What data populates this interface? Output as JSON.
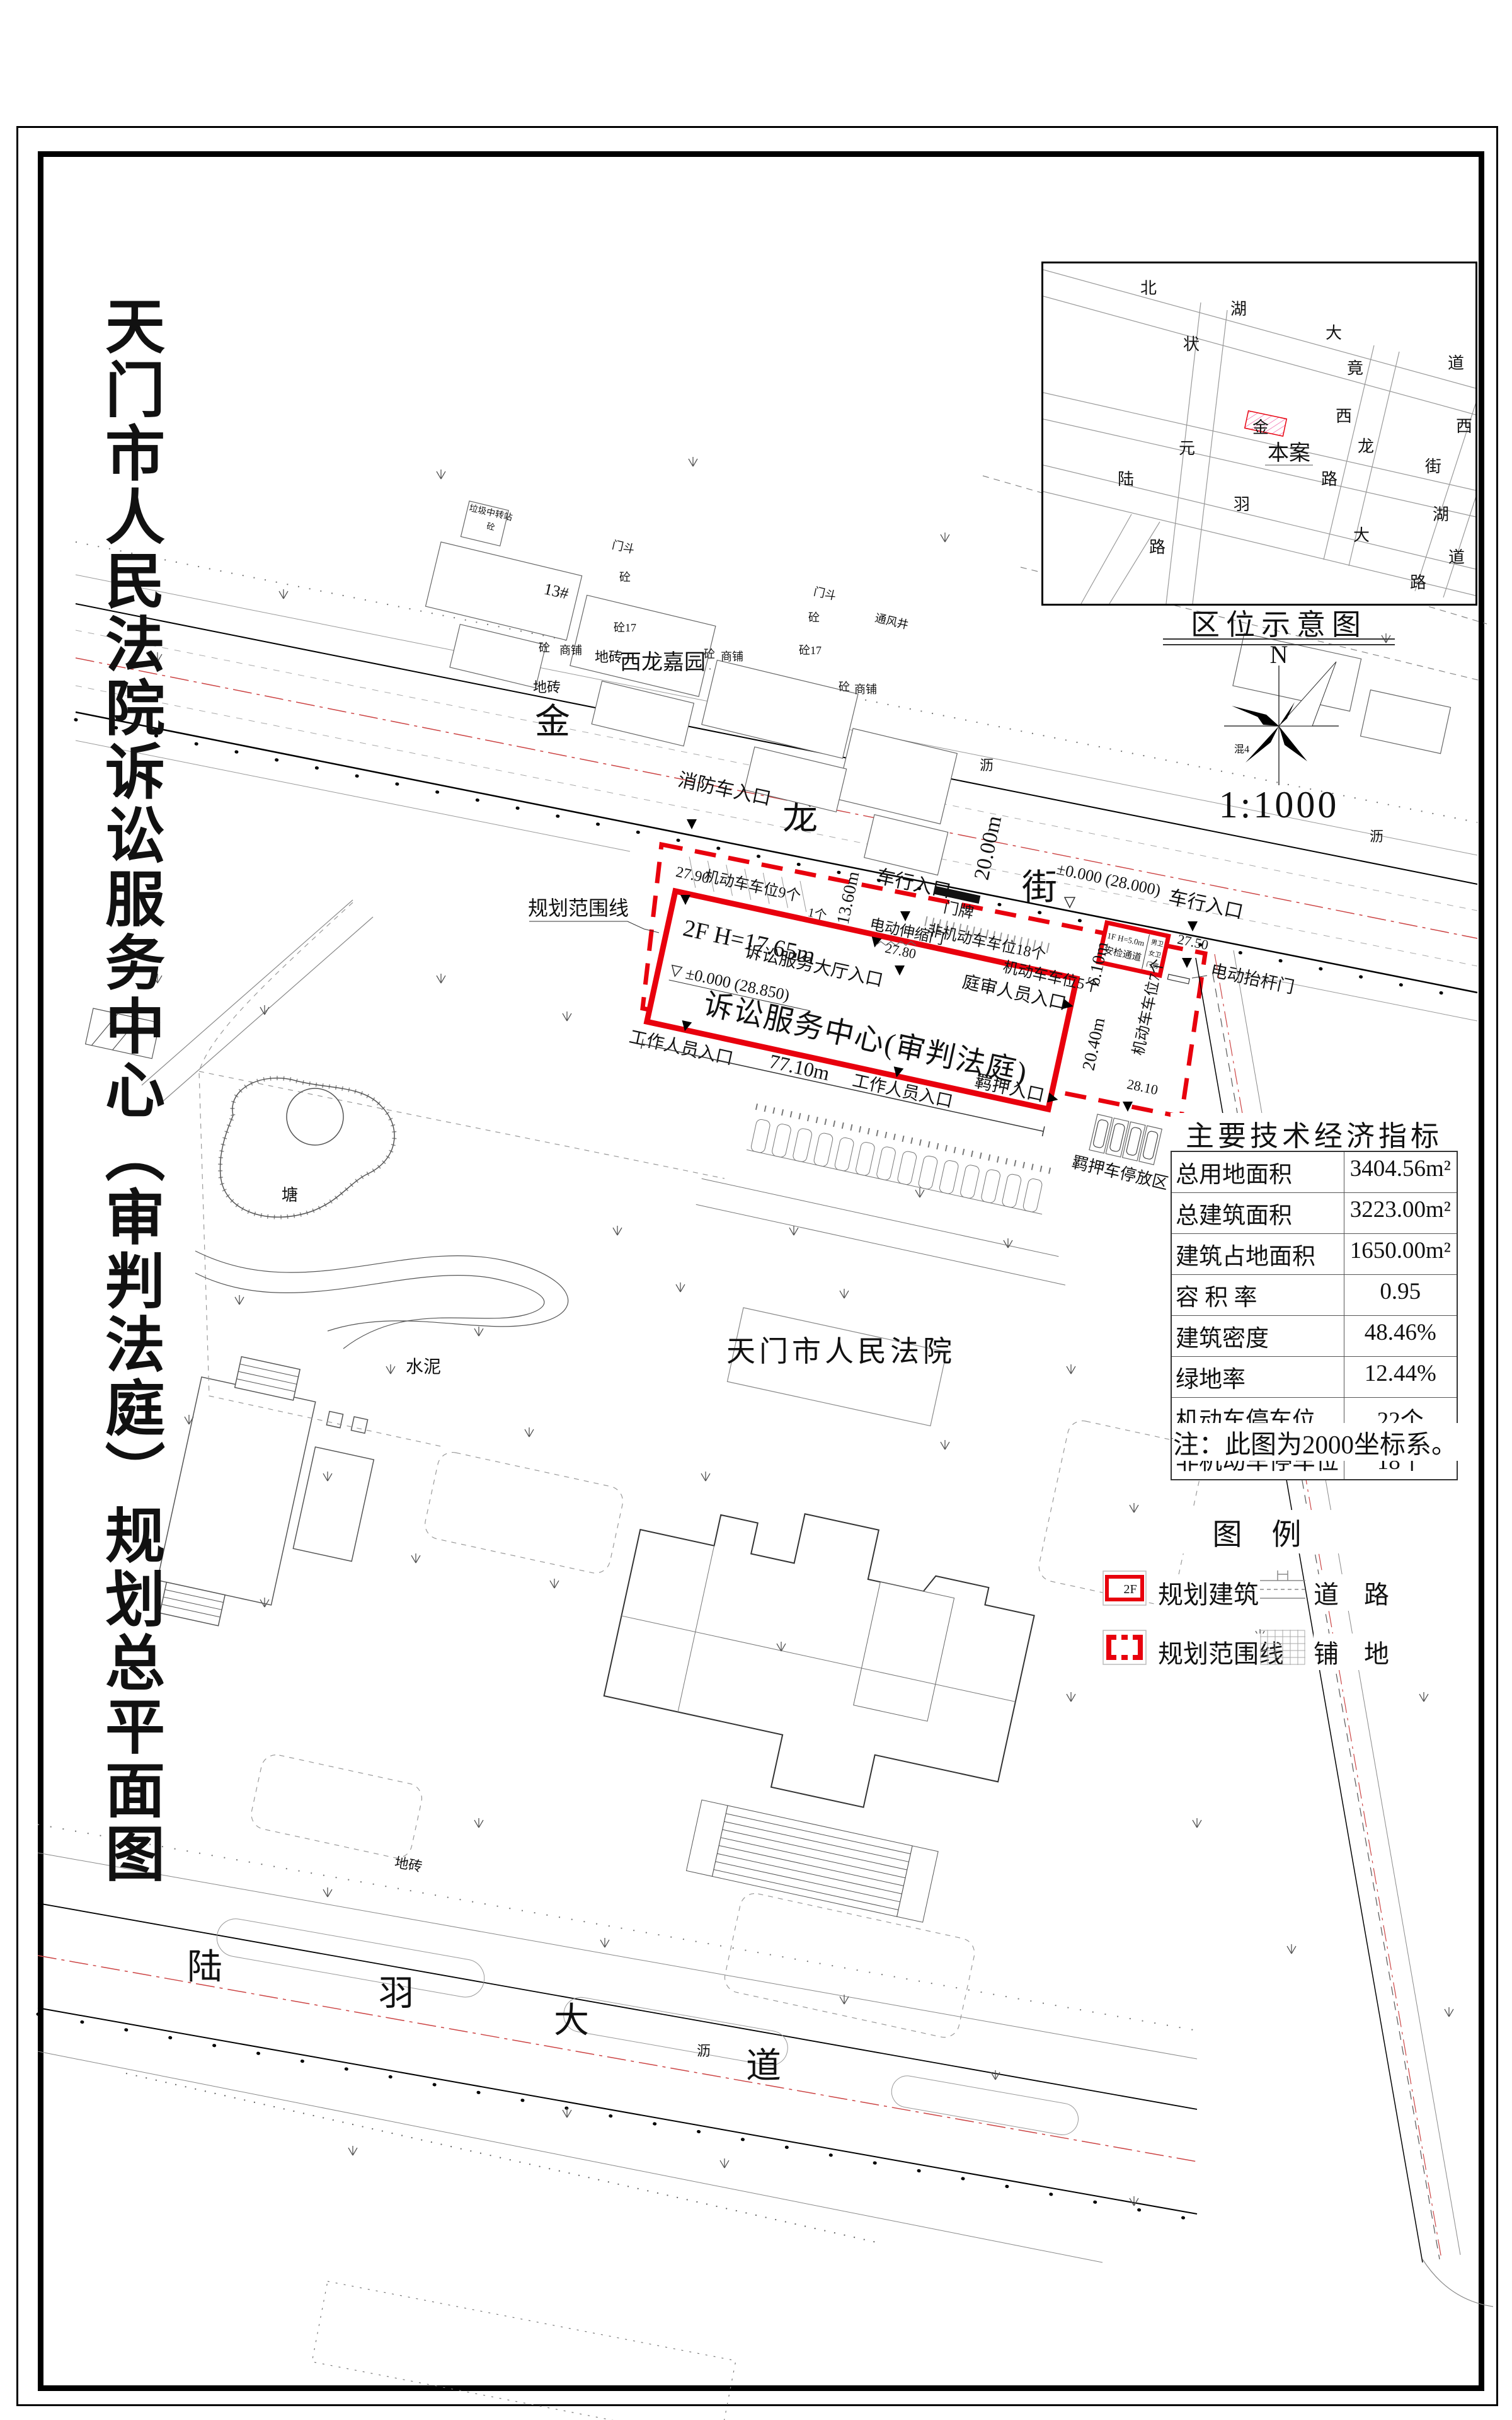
{
  "title": "天门市人民法院诉讼服务中心（审判法庭）规划总平面图",
  "colors": {
    "planning_red": "#e8000d",
    "road_centerline_red": "#cc4444"
  },
  "location_map": {
    "title": "区位示意图",
    "north": "N",
    "scale": "1:1000",
    "site": "本案",
    "note": "混4",
    "streets": {
      "beihu": [
        "北",
        "湖",
        "大",
        "道"
      ],
      "zhuangyuan": [
        "状",
        "元",
        "路"
      ],
      "jingxi": [
        "竟",
        "西",
        "路"
      ],
      "jinlong": [
        "金",
        "龙",
        "街"
      ],
      "xihu": [
        "西",
        "湖",
        "路"
      ],
      "luyu": [
        "陆",
        "羽",
        "大",
        "道"
      ]
    }
  },
  "indicators": {
    "title": "主要技术经济指标",
    "rows": [
      {
        "label": "总用地面积",
        "value": "3404.56m²"
      },
      {
        "label": "总建筑面积",
        "value": "3223.00m²"
      },
      {
        "label": "建筑占地面积",
        "value": "1650.00m²"
      },
      {
        "label": "容 积 率",
        "value": "0.95"
      },
      {
        "label": "建筑密度",
        "value": "48.46%"
      },
      {
        "label": "绿地率",
        "value": "12.44%"
      },
      {
        "label": "机动车停车位",
        "value": "22个"
      },
      {
        "label": "非机动车停车位",
        "value": "18个"
      }
    ],
    "note": "注：此图为2000坐标系。"
  },
  "legend": {
    "title": "图　例",
    "symbol_2f": "2F",
    "planned_building": "规划建筑",
    "planning_boundary": "规划范围线",
    "road": "道　路",
    "paving": "铺　地"
  },
  "plan": {
    "jinlong": [
      "金",
      "龙",
      "街"
    ],
    "luyu": [
      "陆",
      "羽",
      "大",
      "道"
    ],
    "boundary": "规划范围线",
    "building": {
      "floors_height": "2F  H=17.65m",
      "level": "±0.000 (28.850)",
      "name": "诉讼服务中心(审判法庭)"
    },
    "gatehouse": {
      "l1": "1F H=5.0m",
      "l2": "安检通道",
      "wc1": "男卫",
      "wc2": "女卫",
      "room": "门房"
    },
    "labels": {
      "fire_entrance": "消防车入口",
      "vehicle_entrance": "车行入口",
      "hall_entrance": "诉讼服务大厅入口",
      "staff_entrance": "工作人员入口",
      "trial_entrance": "庭审人员入口",
      "detention_entrance": "羁押入口",
      "retractable_gate": "电动伸缩门",
      "barrier_gate": "电动抬杆门",
      "plate": "门牌",
      "p9": "机动车车位9个",
      "p1": "1个",
      "p5": "机动车车位5个",
      "p7": "机动车车位7个",
      "p18": "非机动车车位18个",
      "detention_parking": "羁押车停放区",
      "court": "天门市人民法院",
      "estate": "西龙嘉园",
      "b13": "13#",
      "garbage": "垃圾中转站",
      "concrete": "砼",
      "concrete17": "砼17",
      "shop": "商铺",
      "doorhood": "门斗",
      "vent": "通风井",
      "tile": "地砖",
      "asphalt": "沥",
      "cement": "水泥",
      "pond": "塘"
    },
    "dims": {
      "len": "77.10m",
      "depth": "13.60m",
      "street": "20.00m",
      "d1": "20.40m",
      "d2": "6.10m"
    },
    "levels": {
      "a": "27.90",
      "b": "27.80",
      "c": "27.50",
      "d": "28.10",
      "zero": "±0.000 (28.000)"
    }
  }
}
